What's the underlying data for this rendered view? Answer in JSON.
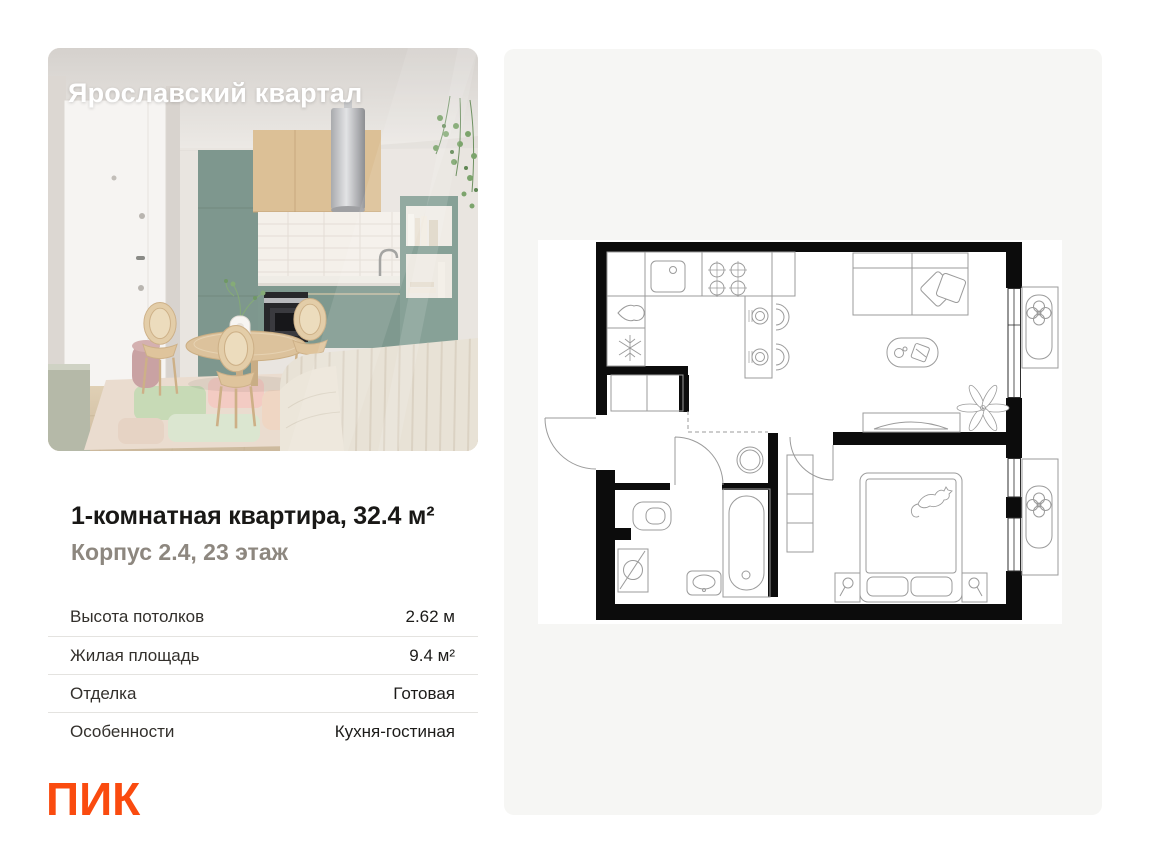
{
  "page": {
    "background": "#ffffff"
  },
  "photo_card": {
    "overlay_title": "Ярославский квартал",
    "description": "Interior render of a kitchen-living room: white entrance door, round wooden dining table with rattan chairs, sage-green kitchen with wood upper cabinets and steel cylinder hood, open green shelf with books, bed with striped beige cover, pastel patch rug, hanging plant"
  },
  "listing": {
    "title": "1-комнатная квартира, 32.4 м²",
    "subtitle": "Корпус 2.4, 23 этаж",
    "details": [
      {
        "label": "Высота потолков",
        "value": "2.62 м"
      },
      {
        "label": "Жилая площадь",
        "value": "9.4 м²"
      },
      {
        "label": "Отделка",
        "value": "Готовая"
      },
      {
        "label": "Особенности",
        "value": "Кухня-гостиная"
      }
    ]
  },
  "brand": {
    "logo_text": "ПИК",
    "color": "#fa4b0f"
  },
  "floor_plan": {
    "description": "Black-and-white architectural plan of the 1-room apartment: kitchen-living area with counter, bar and sofa, bedroom with double bed and cat, bathroom with tub, toilet, washer and sink, hallway closet, two glazed balconies with plant boxes",
    "style": {
      "card_bg": "#f6f6f4",
      "wall_color": "#0c0c0c",
      "line_color": "#9b9b9b"
    }
  }
}
